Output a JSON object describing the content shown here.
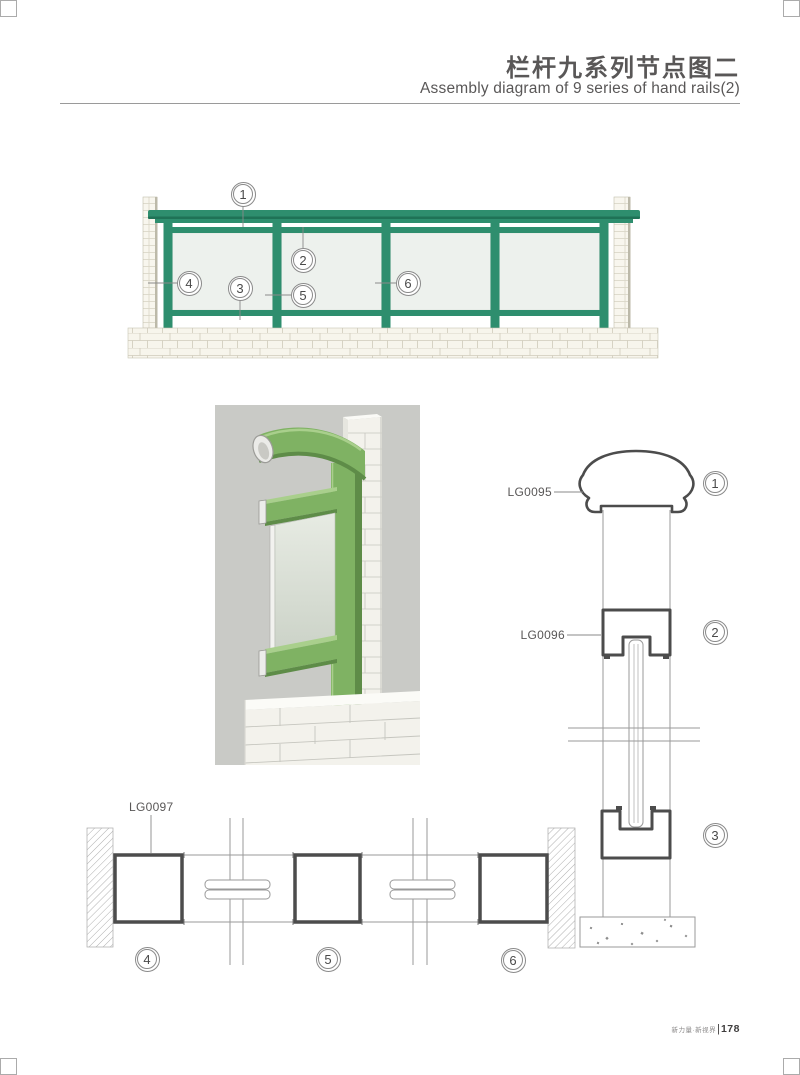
{
  "header": {
    "title_zh": "栏杆九系列节点图二",
    "title_en": "Assembly diagram of 9 series of hand  rails(2)"
  },
  "labels": {
    "lg0095": "LG0095",
    "lg0096": "LG0096",
    "lg0097": "LG0097"
  },
  "callouts": {
    "elevation": [
      "1",
      "2",
      "3",
      "4",
      "5",
      "6"
    ],
    "section": [
      "1",
      "2",
      "3"
    ],
    "plan": [
      "4",
      "5",
      "6"
    ]
  },
  "footer": {
    "brand": "新力量·新视界",
    "divider": "|",
    "page": "178"
  },
  "colors": {
    "rail_teal": "#2e8e6e",
    "rail_teal_dark": "#1f7256",
    "render_green": "#7fb263",
    "render_green_dark": "#5e8c48",
    "drawing_line": "#4c4c4c",
    "thin_line": "#9a9a9a",
    "text_gray": "#595757"
  }
}
